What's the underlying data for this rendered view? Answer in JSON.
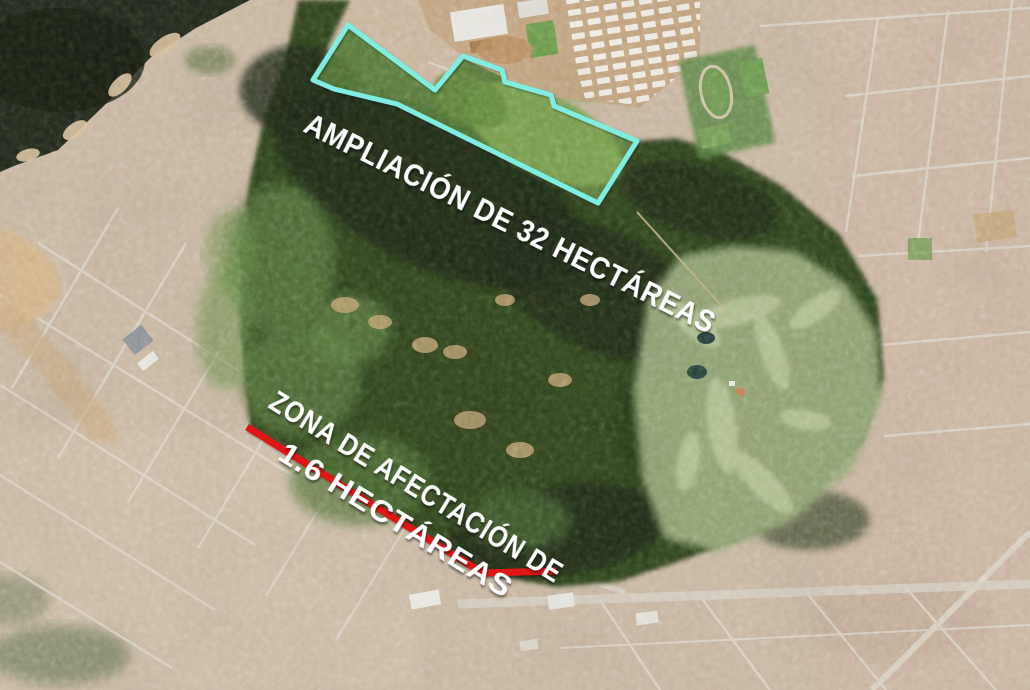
{
  "map": {
    "kind": "satellite-annotation-graphic",
    "annotations": {
      "expansion": {
        "label": "AMPLIACIÓN DE 32 HECTÁREAS",
        "hectares": 32,
        "outline_color": "#7fede2",
        "text_color": "#ffffff"
      },
      "affected_zone": {
        "label_line1": "ZONA DE AFECTACIÓN DE",
        "label_line2": "1.6 HECTÁREAS",
        "hectares": 1.6,
        "line_color": "#e01212",
        "text_color": "#ffffff"
      }
    },
    "palette": {
      "urban": "#c9b7a1",
      "water": "#20261a",
      "forest": "#2e421e",
      "golf": "#98ab79",
      "road": "#ddd6c9"
    }
  }
}
